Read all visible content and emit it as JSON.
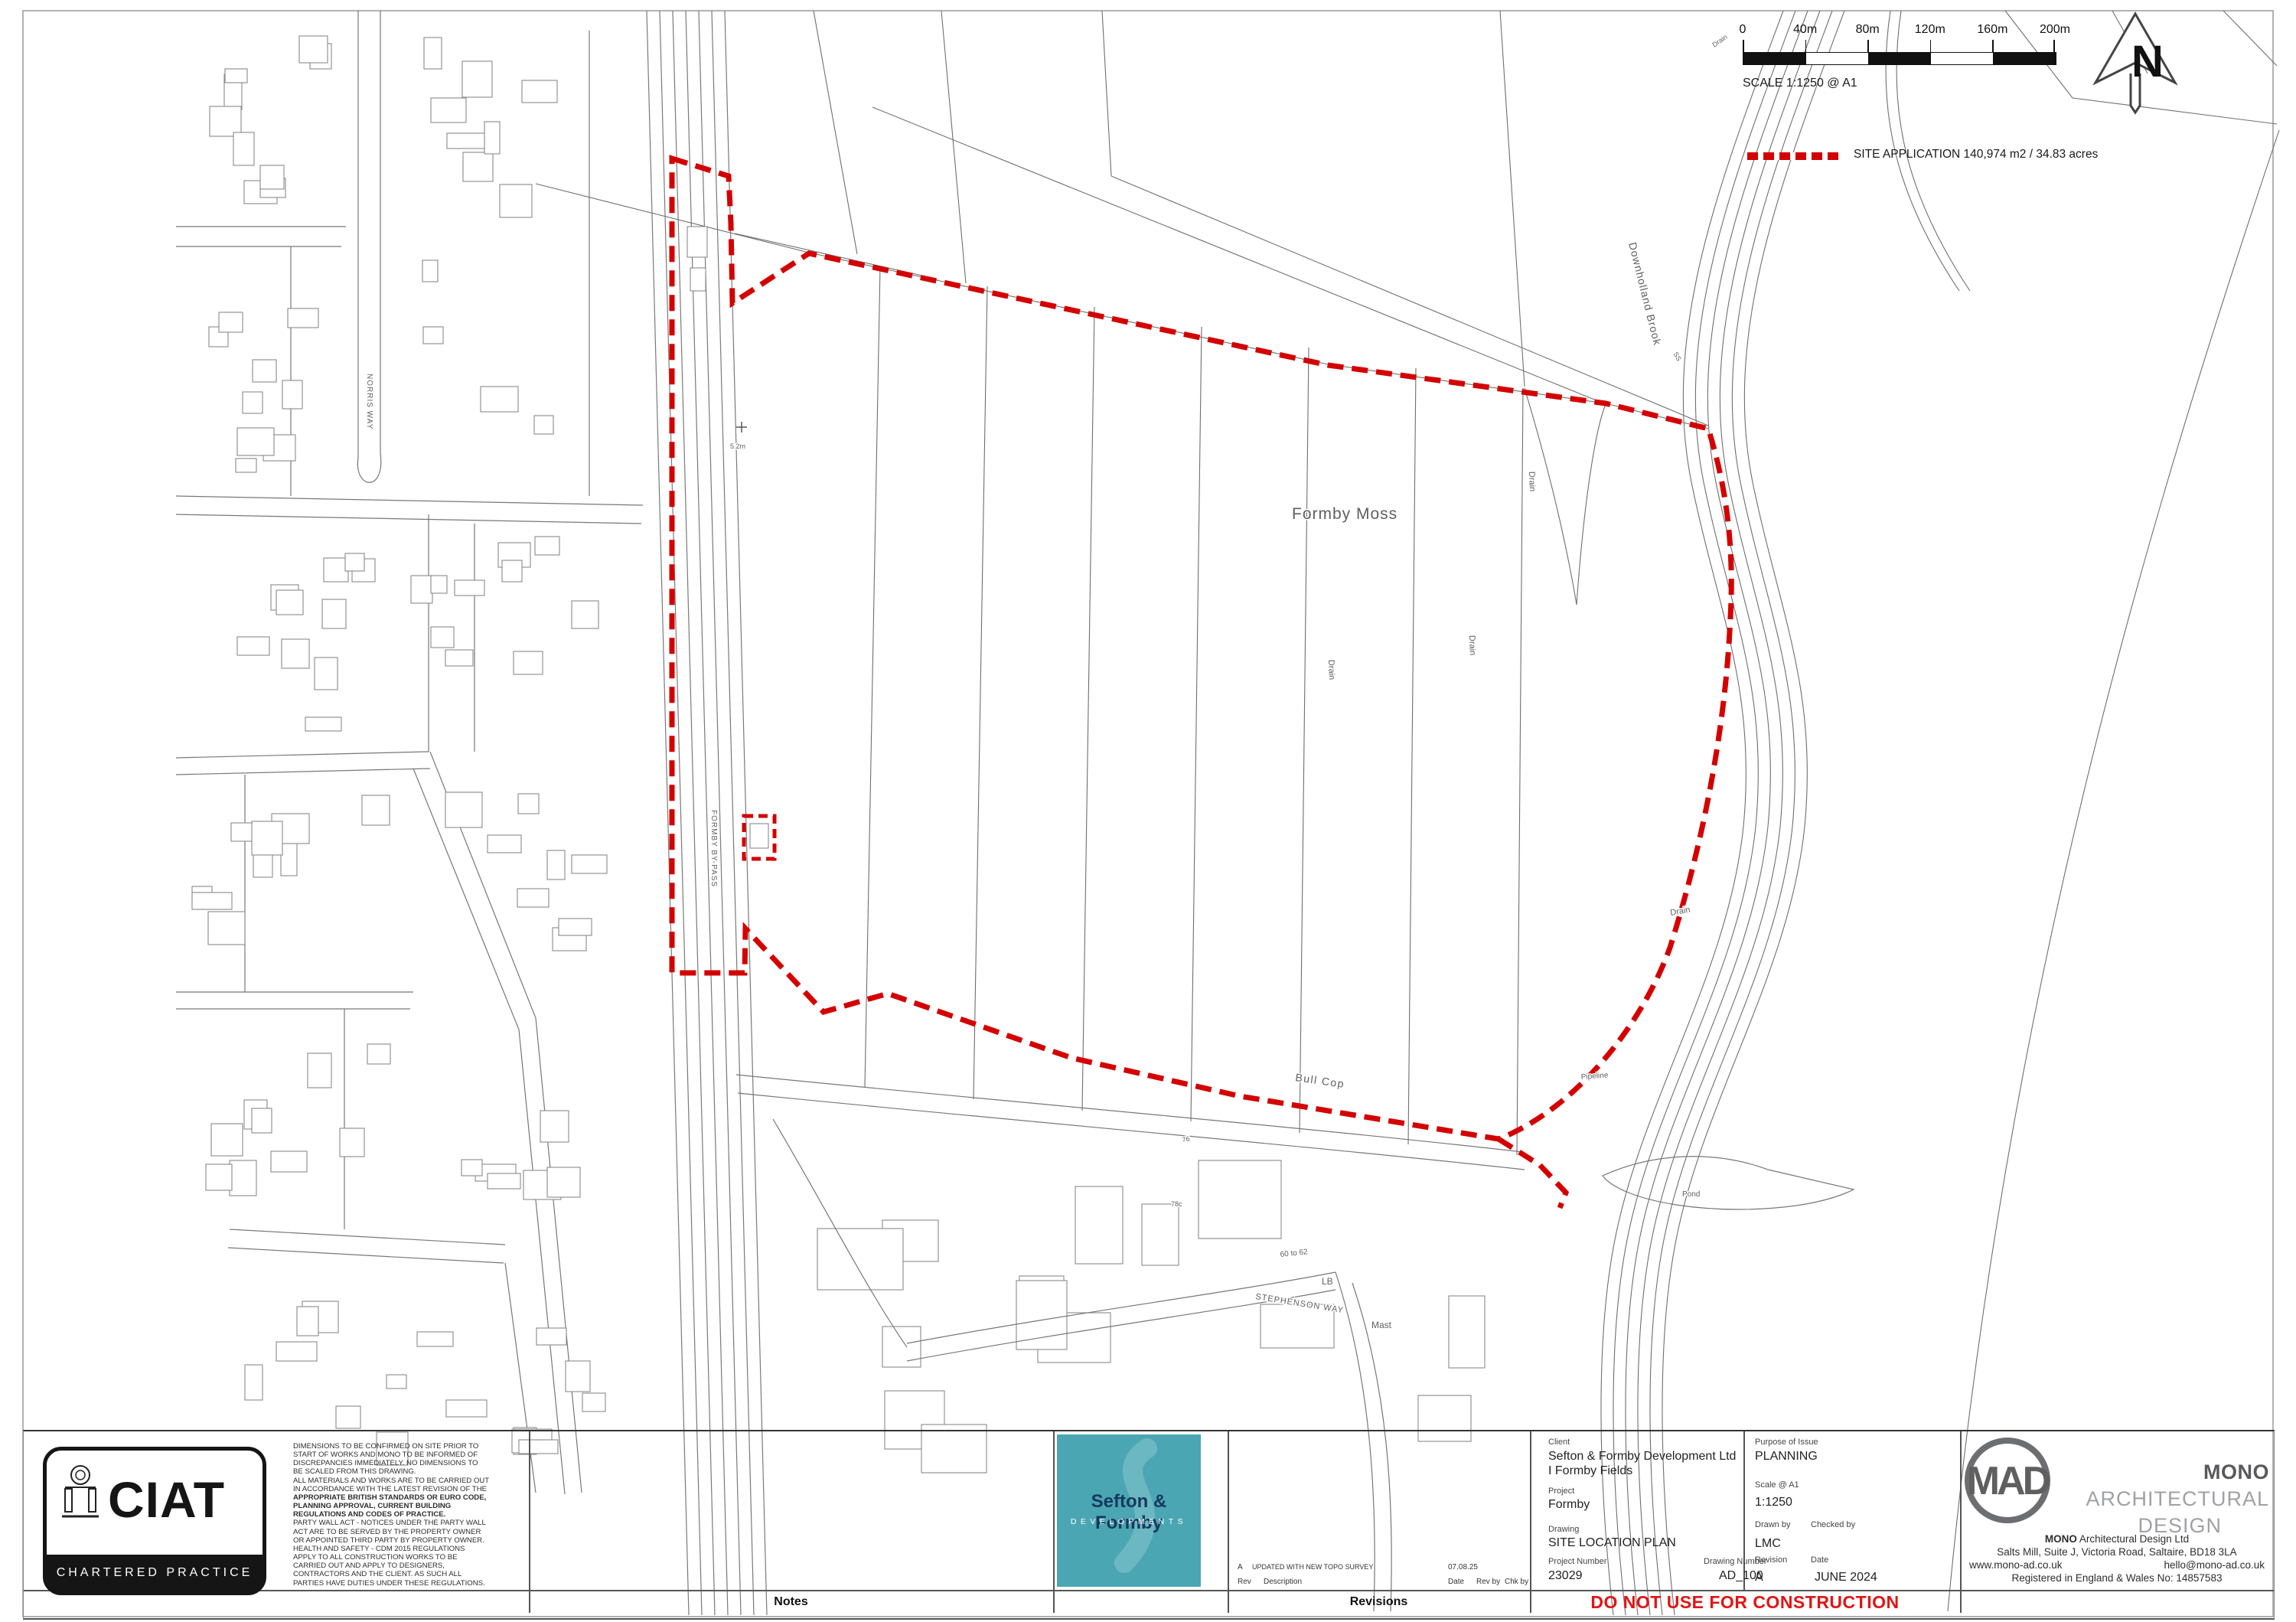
{
  "compass": {
    "label": "N"
  },
  "scale_bar": {
    "ticks": [
      "0",
      "40m",
      "80m",
      "120m",
      "160m",
      "200m"
    ],
    "caption": "SCALE 1:1250 @ A1"
  },
  "legend": {
    "site_application": "SITE APPLICATION 140,974 m2 / 34.83 acres"
  },
  "map": {
    "labels": {
      "formby_moss": "Formby Moss",
      "bull_cop": "Bull Cop",
      "downholland_brook": "Downholland Brook",
      "drain": "Drain",
      "pipeline": "Pipeline",
      "pond": "Pond",
      "stephenson_way": "STEPHENSON WAY",
      "norris_way": "NORRIS WAY",
      "formby_bypass": "FORMBY BY-PASS",
      "lb": "LB",
      "mast": "Mast",
      "no_60_62": "60 to 62",
      "no_76": "76",
      "no_78c": "78c",
      "benchmark": "5.2m",
      "ss": "SS"
    }
  },
  "title_block": {
    "ciat": {
      "acronym": "CIAT",
      "subtitle": "CHARTERED PRACTICE"
    },
    "notes": {
      "bar_label": "Notes",
      "lines": [
        "DIMENSIONS TO BE CONFIRMED ON SITE PRIOR TO",
        "START OF WORKS AND MONO TO BE INFORMED OF",
        "DISCREPANCIES IMMEDIATELY. NO DIMENSIONS TO",
        "BE SCALED FROM THIS DRAWING.",
        "ALL MATERIALS AND WORKS ARE TO BE CARRIED OUT",
        "IN ACCORDANCE WITH THE LATEST REVISION OF THE",
        "APPROPRIATE BRITISH STANDARDS OR EURO CODE,",
        "PLANNING APPROVAL, CURRENT BUILDING",
        "REGULATIONS AND CODES OF PRACTICE.",
        "PARTY WALL ACT - NOTICES UNDER THE PARTY WALL",
        "ACT ARE TO BE SERVED BY THE PROPERTY OWNER",
        "OR APPOINTED THIRD PARTY BY PROPERTY OWNER.",
        "HEALTH AND SAFETY - CDM 2015 REGULATIONS",
        "APPLY TO ALL CONSTRUCTION WORKS TO BE",
        "CARRIED OUT AND APPLY TO DESIGNERS,",
        "CONTRACTORS AND THE CLIENT. AS SUCH ALL",
        "PARTIES HAVE DUTIES UNDER THESE REGULATIONS."
      ]
    },
    "developer_logo": {
      "name": "Sefton & Formby",
      "subtitle": "DEVELOPMENTS"
    },
    "revisions": {
      "bar_label": "Revisions",
      "entry": {
        "rev": "A",
        "description": "UPDATED WITH NEW TOPO SURVEY",
        "date": "07.08.25"
      },
      "headers": {
        "rev": "Rev",
        "description": "Description",
        "date": "Date",
        "rev_by": "Rev by",
        "chk_by": "Chk by"
      }
    },
    "info": {
      "client_label": "Client",
      "client": "Sefton & Formby Development Ltd I Formby Fields",
      "project_label": "Project",
      "project": "Formby",
      "drawing_label": "Drawing",
      "drawing": "SITE LOCATION PLAN",
      "project_number_label": "Project Number",
      "project_number": "23029",
      "drawing_number_label": "Drawing Number",
      "drawing_number": "AD_100",
      "purpose_label": "Purpose of Issue",
      "purpose": "PLANNING",
      "scale_label": "Scale @ A1",
      "scale": "1:1250",
      "drawn_by_label": "Drawn by",
      "checked_by_label": "Checked by",
      "drawn_by": "LMC",
      "revision_label": "Revision",
      "date_label": "Date",
      "revision": "A",
      "date": "JUNE 2024"
    },
    "warning": "DO NOT USE FOR CONSTRUCTION",
    "mono": {
      "logo_letters": "MAD",
      "brand_bold": "MONO",
      "brand_light_1": " ARCHITECTURAL",
      "brand_light_2": "DESIGN",
      "company_bold": "MONO",
      "company_rest": " Architectural Design Ltd",
      "address": "Salts Mill, Suite J, Victoria Road, Saltaire, BD18 3LA",
      "website": "www.mono-ad.co.uk",
      "email": "hello@mono-ad.co.uk",
      "registration": "Registered in England & Wales No: 14857583"
    }
  }
}
